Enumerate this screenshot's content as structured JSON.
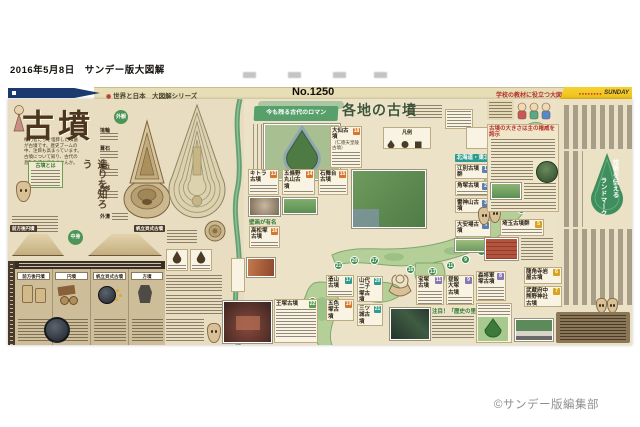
{
  "meta": {
    "date_line": "2016年5月8日　サンデー版大図解",
    "copyright": "©サンデー版編集部"
  },
  "header": {
    "series_mark": "◉",
    "series": "世界と日本　大図解シリーズ",
    "issue": "No.1250",
    "tagline": "学校の教材に役立つ大図解",
    "brand_dots": "●●●●●●●●",
    "brand": "SUNDAY"
  },
  "feature": {
    "title": "古墳",
    "intro": "権力者たちを埋葬した墳墓が古墳です。歴史ブームの中、注目も高まっています。古墳について知り、古代の息吹を感じてみませんか。",
    "box_title": "古墳とは",
    "build_title": "造りを知ろう",
    "labels": {
      "gaikan": "外観",
      "haniwa": "埴輪",
      "fukiishi": "葺石",
      "funkyu": "墳丘",
      "naibu": "内部",
      "gaigo": "外濠",
      "nakami": "中身",
      "zenpo": "前方後円墳",
      "hotate": "帆立貝式古墳",
      "enpun": "円墳",
      "hofun": "方墳"
    }
  },
  "map": {
    "banner_lead": "今も残る古代のロマン",
    "banner_title": "各地の古墳",
    "legend_title": "凡例",
    "region": "北海道・東北",
    "wall_note": "壁画が有名",
    "spot_note": "注目！「歴史の里」",
    "markers": [
      "1",
      "2",
      "3",
      "4",
      "5",
      "8",
      "9",
      "11",
      "13",
      "16",
      "17",
      "20",
      "21",
      "22"
    ],
    "entries": [
      {
        "name": "大仙古墳",
        "sub": "（仁徳天皇陵古墳）",
        "no": "18"
      },
      {
        "name": "キトラ古墳",
        "no": "13"
      },
      {
        "name": "五條野丸山古墳",
        "no": "14"
      },
      {
        "name": "石舞台古墳",
        "no": "15"
      },
      {
        "name": "高松塚古墳",
        "no": "16"
      },
      {
        "name": "江別古墳群",
        "no": "1"
      },
      {
        "name": "角塚古墳",
        "no": "2"
      },
      {
        "name": "雷神山古墳",
        "no": "3"
      },
      {
        "name": "大安場古墳",
        "no": "4"
      },
      {
        "name": "埼玉古墳群",
        "no": "5"
      },
      {
        "name": "龍角寺岩屋古墳",
        "no": "6"
      },
      {
        "name": "武蔵府中熊野神社古墳",
        "no": "7"
      },
      {
        "name": "森将軍塚古墳",
        "no": "8"
      },
      {
        "name": "昼飯大塚古墳",
        "no": "9"
      },
      {
        "name": "宝塚古墳",
        "no": "11"
      },
      {
        "name": "造山古墳",
        "no": "17"
      },
      {
        "name": "五色塚古墳",
        "no": "19"
      },
      {
        "name": "山代二子塚古墳",
        "no": "20"
      },
      {
        "name": "三ツ城古墳",
        "no": "21"
      },
      {
        "name": "王塚古墳",
        "no": "22"
      }
    ]
  },
  "article": {
    "keyhole_line1": "技術を伝える",
    "keyhole_line2": "ランドマーク",
    "box_heading": "古墳の大きさは主の権威を誇示"
  }
}
